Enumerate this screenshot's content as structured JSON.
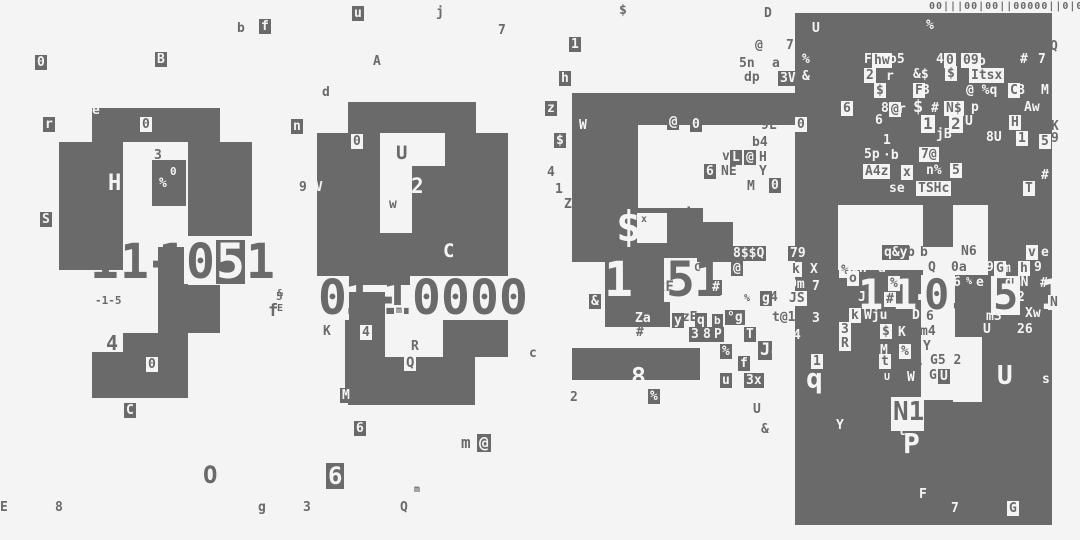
{
  "meta": {
    "description": "Abstract glitch-art composition: four block clusters with large corrupted digit strings and scattered terminal glyphs",
    "bg_color": "#f4f4f4",
    "ink_color": "#6a6a6a",
    "light_color": "#f4f4f4"
  },
  "top_strip": {
    "x": 929,
    "y": 1,
    "size": 10,
    "text": "00|||00|00||00000||0|0|00||000|"
  },
  "blobs": [
    [
      92,
      108,
      128,
      34
    ],
    [
      59,
      142,
      64,
      128
    ],
    [
      188,
      142,
      64,
      94
    ],
    [
      158,
      247,
      30,
      86
    ],
    [
      188,
      285,
      32,
      48
    ],
    [
      123,
      333,
      65,
      37
    ],
    [
      92,
      352,
      96,
      46
    ],
    [
      152,
      160,
      34,
      46
    ],
    [
      348,
      102,
      128,
      31
    ],
    [
      317,
      133,
      63,
      152
    ],
    [
      380,
      233,
      33,
      52
    ],
    [
      445,
      133,
      63,
      150
    ],
    [
      412,
      166,
      33,
      117
    ],
    [
      345,
      292,
      40,
      100
    ],
    [
      348,
      357,
      127,
      48
    ],
    [
      443,
      283,
      65,
      74
    ],
    [
      572,
      93,
      246,
      32
    ],
    [
      572,
      125,
      66,
      83
    ],
    [
      572,
      208,
      131,
      54
    ],
    [
      667,
      222,
      66,
      40
    ],
    [
      605,
      262,
      65,
      48
    ],
    [
      605,
      310,
      65,
      17
    ],
    [
      572,
      348,
      128,
      32
    ],
    [
      795,
      13,
      257,
      512
    ]
  ],
  "holes": [
    [
      637,
      213,
      30,
      30
    ],
    [
      838,
      205,
      85,
      65
    ],
    [
      953,
      205,
      35,
      70
    ],
    [
      923,
      247,
      30,
      28
    ],
    [
      921,
      275,
      34,
      125
    ],
    [
      953,
      337,
      29,
      65
    ],
    [
      891,
      397,
      33,
      34
    ],
    [
      925,
      389,
      48,
      8
    ]
  ],
  "numbers": [
    {
      "name": "cluster1-number",
      "reading": "11-1051",
      "y": 240,
      "size": 48,
      "glyphs": [
        [
          90,
          "1",
          "n"
        ],
        [
          120,
          "1",
          "n"
        ],
        [
          146,
          "-",
          "n"
        ],
        [
          158,
          "1",
          "n"
        ],
        [
          184,
          "0",
          "l"
        ],
        [
          216,
          "5",
          "d"
        ],
        [
          246,
          "1",
          "n"
        ]
      ]
    },
    {
      "name": "cluster2-number",
      "reading": "01-10000",
      "y": 276,
      "size": 48,
      "glyphs": [
        [
          316,
          "0",
          "l"
        ],
        [
          344,
          "1",
          "n"
        ],
        [
          370,
          "-",
          "n"
        ],
        [
          382,
          "1",
          "n"
        ],
        [
          410,
          "0",
          "l"
        ],
        [
          439,
          "0",
          "l"
        ],
        [
          468,
          "0",
          "l"
        ],
        [
          497,
          "0",
          "l"
        ]
      ]
    },
    {
      "name": "cluster3-number",
      "reading": "1151",
      "y": 258,
      "size": 48,
      "glyphs": [
        [
          604,
          "1",
          "w"
        ],
        [
          640,
          "1",
          "n"
        ],
        [
          664,
          "5",
          "l"
        ],
        [
          694,
          "1",
          "n"
        ]
      ]
    },
    {
      "name": "cluster4-number",
      "reading": "11-0551",
      "y": 276,
      "size": 42,
      "glyphs": [
        [
          858,
          "1",
          "w"
        ],
        [
          892,
          "1",
          "w"
        ],
        [
          912,
          "-",
          "w"
        ],
        [
          922,
          "0",
          "l"
        ],
        [
          951,
          "5",
          "n"
        ],
        [
          991,
          "5",
          "l"
        ],
        [
          1040,
          "1",
          "w"
        ]
      ]
    }
  ],
  "cells": [
    [
      35,
      55,
      "0",
      "d"
    ],
    [
      155,
      52,
      "B",
      "d"
    ],
    [
      237,
      22,
      "b",
      "n"
    ],
    [
      259,
      19,
      "f",
      "d"
    ],
    [
      352,
      6,
      "u",
      "d"
    ],
    [
      436,
      6,
      "j",
      "n"
    ],
    [
      498,
      24,
      "7",
      "n"
    ],
    [
      373,
      55,
      "A",
      "n"
    ],
    [
      322,
      86,
      "d",
      "n"
    ],
    [
      291,
      119,
      "n",
      "d"
    ],
    [
      43,
      117,
      "r",
      "d"
    ],
    [
      40,
      212,
      "S",
      "d"
    ],
    [
      92,
      104,
      "e",
      "w"
    ],
    [
      140,
      117,
      "0",
      "l"
    ],
    [
      108,
      173,
      "H",
      "w",
      22
    ],
    [
      154,
      149,
      "3",
      "n"
    ],
    [
      159,
      177,
      "%",
      "w",
      13
    ],
    [
      170,
      166,
      "0",
      "w",
      11
    ],
    [
      95,
      295,
      "-1-5",
      "n",
      11
    ],
    [
      276,
      291,
      "5",
      "n",
      11
    ],
    [
      268,
      303,
      "f",
      "n",
      17
    ],
    [
      106,
      333,
      "4",
      "n",
      20
    ],
    [
      146,
      357,
      "0",
      "l"
    ],
    [
      124,
      403,
      "C",
      "d"
    ],
    [
      0,
      501,
      "E",
      "n"
    ],
    [
      55,
      501,
      "8",
      "n"
    ],
    [
      203,
      463,
      "O",
      "n",
      24
    ],
    [
      258,
      501,
      "g",
      "n"
    ],
    [
      303,
      501,
      "3",
      "n"
    ],
    [
      326,
      463,
      "6",
      "d",
      24
    ],
    [
      354,
      421,
      "6",
      "d"
    ],
    [
      400,
      501,
      "Q",
      "n"
    ],
    [
      414,
      485,
      "m",
      "n",
      10
    ],
    [
      461,
      435,
      "m",
      "n",
      16
    ],
    [
      477,
      434,
      "@",
      "d",
      16
    ],
    [
      277,
      289,
      "&",
      "n",
      10
    ],
    [
      277,
      304,
      "E",
      "n",
      10
    ],
    [
      299,
      181,
      "9",
      "n"
    ],
    [
      315,
      181,
      "V",
      "w"
    ],
    [
      351,
      134,
      "0",
      "l"
    ],
    [
      396,
      144,
      "U",
      "n",
      19
    ],
    [
      411,
      176,
      "2",
      "w",
      21
    ],
    [
      387,
      197,
      "w",
      "l"
    ],
    [
      443,
      242,
      "C",
      "w",
      19
    ],
    [
      402,
      247,
      "3",
      "n"
    ],
    [
      340,
      388,
      "M",
      "d"
    ],
    [
      411,
      340,
      "R",
      "n"
    ],
    [
      404,
      355,
      "Q",
      "l",
      14
    ],
    [
      425,
      363,
      "b",
      "n",
      23
    ],
    [
      529,
      347,
      "c",
      "n"
    ],
    [
      394,
      305,
      "m",
      "l",
      10
    ],
    [
      321,
      324,
      "K",
      "l"
    ],
    [
      360,
      325,
      "4",
      "l"
    ],
    [
      545,
      101,
      "z",
      "d"
    ],
    [
      554,
      133,
      "$",
      "d"
    ],
    [
      547,
      166,
      "4",
      "n"
    ],
    [
      555,
      183,
      "1",
      "n"
    ],
    [
      564,
      198,
      "Z",
      "n"
    ],
    [
      569,
      37,
      "1",
      "d"
    ],
    [
      619,
      4,
      "$",
      "n"
    ],
    [
      559,
      71,
      "h",
      "d"
    ],
    [
      588,
      80,
      "X",
      "w",
      17
    ],
    [
      764,
      7,
      "D",
      "n"
    ],
    [
      755,
      39,
      "@",
      "n"
    ],
    [
      786,
      39,
      "7",
      "n"
    ],
    [
      739,
      57,
      "5n",
      "n"
    ],
    [
      772,
      57,
      "a",
      "n"
    ],
    [
      744,
      71,
      "dp",
      "n"
    ],
    [
      778,
      71,
      "3V",
      "d"
    ],
    [
      579,
      119,
      "W",
      "w"
    ],
    [
      725,
      102,
      "J",
      "n"
    ],
    [
      738,
      91,
      "7",
      "n",
      24
    ],
    [
      761,
      102,
      "0Z",
      "n"
    ],
    [
      761,
      119,
      "9L",
      "n"
    ],
    [
      667,
      114,
      "@",
      "d",
      14
    ],
    [
      690,
      117,
      "0",
      "d"
    ],
    [
      722,
      136,
      "win",
      "w"
    ],
    [
      752,
      136,
      "b4",
      "n"
    ],
    [
      722,
      150,
      "v",
      "n"
    ],
    [
      730,
      150,
      "L",
      "d"
    ],
    [
      744,
      150,
      "@",
      "d"
    ],
    [
      759,
      151,
      "H",
      "n"
    ],
    [
      704,
      164,
      "6",
      "d"
    ],
    [
      721,
      165,
      "NE",
      "n"
    ],
    [
      759,
      165,
      "Y",
      "n"
    ],
    [
      747,
      180,
      "M",
      "n"
    ],
    [
      769,
      178,
      "0",
      "d"
    ],
    [
      616,
      206,
      "$",
      "w",
      42
    ],
    [
      641,
      215,
      "x",
      "n",
      10
    ],
    [
      656,
      216,
      "°",
      "w"
    ],
    [
      683,
      207,
      "i",
      "n",
      18
    ],
    [
      642,
      228,
      "x",
      "w",
      10
    ],
    [
      698,
      248,
      "°",
      "n",
      9
    ],
    [
      731,
      246,
      "8$$Q",
      "d"
    ],
    [
      788,
      246,
      "79",
      "d"
    ],
    [
      731,
      261,
      "@",
      "d"
    ],
    [
      752,
      262,
      "i",
      "w",
      14
    ],
    [
      790,
      262,
      "k",
      "l"
    ],
    [
      808,
      262,
      "X",
      "d"
    ],
    [
      634,
      260,
      "Vl",
      "n",
      11
    ],
    [
      640,
      276,
      "f",
      "n",
      12
    ],
    [
      657,
      280,
      "2F",
      "n",
      14
    ],
    [
      694,
      262,
      "C",
      "n",
      11
    ],
    [
      710,
      280,
      "#",
      "d"
    ],
    [
      731,
      292,
      "W",
      "w"
    ],
    [
      744,
      294,
      "%",
      "n",
      10
    ],
    [
      760,
      291,
      "g",
      "d"
    ],
    [
      770,
      291,
      "4",
      "n"
    ],
    [
      787,
      291,
      "JS",
      "l"
    ],
    [
      789,
      278,
      "Dm",
      "w"
    ],
    [
      812,
      280,
      "7",
      "w"
    ],
    [
      589,
      294,
      "&",
      "d"
    ],
    [
      674,
      311,
      "qzE",
      "n"
    ],
    [
      633,
      311,
      "Za",
      "d"
    ],
    [
      636,
      326,
      "#",
      "n"
    ],
    [
      672,
      313,
      "y",
      "d"
    ],
    [
      695,
      313,
      "q",
      "d"
    ],
    [
      712,
      314,
      "b",
      "d",
      11
    ],
    [
      725,
      310,
      "°g",
      "d"
    ],
    [
      772,
      311,
      "t@1",
      "n"
    ],
    [
      812,
      312,
      "3",
      "w"
    ],
    [
      689,
      327,
      "3",
      "d"
    ],
    [
      701,
      327,
      "8",
      "d"
    ],
    [
      712,
      327,
      "P",
      "d"
    ],
    [
      744,
      327,
      "T",
      "d"
    ],
    [
      793,
      329,
      "4",
      "w"
    ],
    [
      720,
      344,
      "%",
      "d"
    ],
    [
      758,
      341,
      "J",
      "d",
      17
    ],
    [
      771,
      344,
      "gk",
      "w",
      15
    ],
    [
      738,
      356,
      "f",
      "d"
    ],
    [
      786,
      356,
      "i",
      "w"
    ],
    [
      720,
      373,
      "u",
      "d"
    ],
    [
      744,
      373,
      "3x",
      "d"
    ],
    [
      570,
      391,
      "2",
      "n"
    ],
    [
      631,
      364,
      "8",
      "w",
      25
    ],
    [
      648,
      389,
      "%",
      "d"
    ],
    [
      753,
      403,
      "U",
      "n"
    ],
    [
      761,
      423,
      "&",
      "n"
    ],
    [
      812,
      22,
      "U",
      "w"
    ],
    [
      926,
      19,
      "%",
      "w"
    ],
    [
      1050,
      40,
      "Q",
      "n"
    ],
    [
      802,
      53,
      "%",
      "w"
    ],
    [
      802,
      70,
      "&",
      "w"
    ],
    [
      864,
      53,
      "F",
      "w"
    ],
    [
      872,
      53,
      "hw",
      "l"
    ],
    [
      889,
      53,
      "o5",
      "w"
    ],
    [
      936,
      53,
      "4",
      "w"
    ],
    [
      944,
      53,
      "0",
      "l"
    ],
    [
      961,
      53,
      "09",
      "l"
    ],
    [
      978,
      55,
      "o",
      "w"
    ],
    [
      1020,
      53,
      "#",
      "w"
    ],
    [
      1038,
      53,
      "7",
      "w"
    ],
    [
      864,
      68,
      "2",
      "l"
    ],
    [
      886,
      70,
      "r",
      "w"
    ],
    [
      913,
      68,
      "&$",
      "w"
    ],
    [
      945,
      66,
      "$",
      "l"
    ],
    [
      969,
      68,
      "Itsx",
      "l"
    ],
    [
      874,
      83,
      "$",
      "l"
    ],
    [
      913,
      83,
      "F",
      "l"
    ],
    [
      922,
      84,
      "3",
      "w"
    ],
    [
      966,
      84,
      "@ %q",
      "w"
    ],
    [
      1008,
      83,
      "C",
      "l"
    ],
    [
      1017,
      84,
      "B",
      "w"
    ],
    [
      1041,
      84,
      "M",
      "w"
    ],
    [
      881,
      102,
      "8",
      "w"
    ],
    [
      889,
      102,
      "@",
      "l"
    ],
    [
      898,
      103,
      "r",
      "w"
    ],
    [
      913,
      99,
      "$",
      "w",
      17
    ],
    [
      931,
      102,
      "#",
      "w"
    ],
    [
      944,
      101,
      "N$",
      "l"
    ],
    [
      971,
      101,
      "p",
      "w"
    ],
    [
      1024,
      101,
      "Aw",
      "w"
    ],
    [
      841,
      101,
      "6",
      "l"
    ],
    [
      875,
      114,
      "6",
      "w"
    ],
    [
      795,
      117,
      "0",
      "l"
    ],
    [
      883,
      134,
      "1",
      "w"
    ],
    [
      921,
      115,
      "1",
      "l",
      16
    ],
    [
      949,
      115,
      "2",
      "l",
      16
    ],
    [
      965,
      115,
      "U",
      "w"
    ],
    [
      1009,
      115,
      "H",
      "l"
    ],
    [
      1051,
      120,
      "K",
      "n"
    ],
    [
      936,
      128,
      "jB",
      "w"
    ],
    [
      986,
      131,
      "8U",
      "w"
    ],
    [
      1016,
      131,
      "1",
      "l"
    ],
    [
      1039,
      134,
      "5",
      "l"
    ],
    [
      1051,
      132,
      "9",
      "n"
    ],
    [
      864,
      148,
      "5p",
      "w"
    ],
    [
      883,
      149,
      "·b",
      "w"
    ],
    [
      919,
      147,
      "7@",
      "l"
    ],
    [
      863,
      164,
      "A4z",
      "l"
    ],
    [
      901,
      165,
      "x",
      "l"
    ],
    [
      926,
      164,
      "n%",
      "w"
    ],
    [
      950,
      163,
      "5",
      "l"
    ],
    [
      1041,
      169,
      "#",
      "w"
    ],
    [
      889,
      182,
      "se",
      "w"
    ],
    [
      916,
      181,
      "TSHc",
      "l"
    ],
    [
      1023,
      181,
      "T",
      "l"
    ],
    [
      920,
      246,
      "b",
      "n"
    ],
    [
      961,
      245,
      "N6",
      "n"
    ],
    [
      882,
      245,
      "q&y",
      "d"
    ],
    [
      907,
      246,
      "b",
      "n"
    ],
    [
      1026,
      245,
      "v",
      "l"
    ],
    [
      1041,
      246,
      "e",
      "w"
    ],
    [
      851,
      262,
      "0h",
      "w"
    ],
    [
      878,
      262,
      "a",
      "w"
    ],
    [
      928,
      261,
      "Q",
      "n"
    ],
    [
      951,
      261,
      "0a",
      "n"
    ],
    [
      986,
      261,
      "9",
      "w"
    ],
    [
      994,
      261,
      "G",
      "l"
    ],
    [
      1003,
      262,
      "m",
      "w"
    ],
    [
      1018,
      261,
      "h",
      "l"
    ],
    [
      1034,
      261,
      "9",
      "w"
    ],
    [
      839,
      263,
      "%",
      "l"
    ],
    [
      847,
      271,
      "o",
      "l"
    ],
    [
      888,
      276,
      "%",
      "l"
    ],
    [
      899,
      277,
      "-",
      "w"
    ],
    [
      953,
      276,
      "6",
      "w"
    ],
    [
      966,
      277,
      "%",
      "w",
      10
    ],
    [
      976,
      276,
      "e",
      "w"
    ],
    [
      1005,
      276,
      "dmN",
      "w"
    ],
    [
      1040,
      277,
      "#",
      "w"
    ],
    [
      858,
      291,
      "J",
      "w"
    ],
    [
      884,
      292,
      "#",
      "l"
    ],
    [
      1017,
      291,
      "2",
      "w"
    ],
    [
      1048,
      295,
      "N",
      "l"
    ],
    [
      849,
      308,
      "k",
      "l"
    ],
    [
      864,
      309,
      "Wju",
      "w"
    ],
    [
      912,
      309,
      "D",
      "w"
    ],
    [
      926,
      310,
      "6",
      "n"
    ],
    [
      986,
      310,
      "m3",
      "w"
    ],
    [
      1025,
      307,
      "Xw",
      "w"
    ],
    [
      839,
      322,
      "3",
      "l"
    ],
    [
      880,
      324,
      "$",
      "l"
    ],
    [
      898,
      326,
      "K",
      "w"
    ],
    [
      920,
      325,
      "m4",
      "n"
    ],
    [
      983,
      323,
      "U",
      "w"
    ],
    [
      1017,
      323,
      "26",
      "w"
    ],
    [
      839,
      336,
      "R",
      "l"
    ],
    [
      880,
      344,
      "M",
      "w"
    ],
    [
      899,
      344,
      "%",
      "l"
    ],
    [
      923,
      340,
      "Y",
      "n"
    ],
    [
      811,
      354,
      "1",
      "l"
    ],
    [
      879,
      354,
      "t",
      "l"
    ],
    [
      914,
      356,
      "%",
      "n"
    ],
    [
      930,
      354,
      "G5 2",
      "n"
    ],
    [
      806,
      365,
      "q",
      "w",
      28
    ],
    [
      884,
      373,
      "U",
      "w",
      10
    ],
    [
      907,
      371,
      "W",
      "w"
    ],
    [
      929,
      369,
      "G",
      "n"
    ],
    [
      938,
      369,
      "U",
      "d"
    ],
    [
      997,
      363,
      "U",
      "w",
      26
    ],
    [
      1042,
      373,
      "s",
      "w"
    ],
    [
      836,
      419,
      "Y",
      "w"
    ],
    [
      893,
      399,
      "N1",
      "n",
      26
    ],
    [
      898,
      425,
      "t",
      "w"
    ],
    [
      903,
      430,
      "P",
      "w",
      28
    ],
    [
      919,
      488,
      "F",
      "w"
    ],
    [
      951,
      502,
      "7",
      "w"
    ],
    [
      1007,
      501,
      "G",
      "l"
    ]
  ]
}
